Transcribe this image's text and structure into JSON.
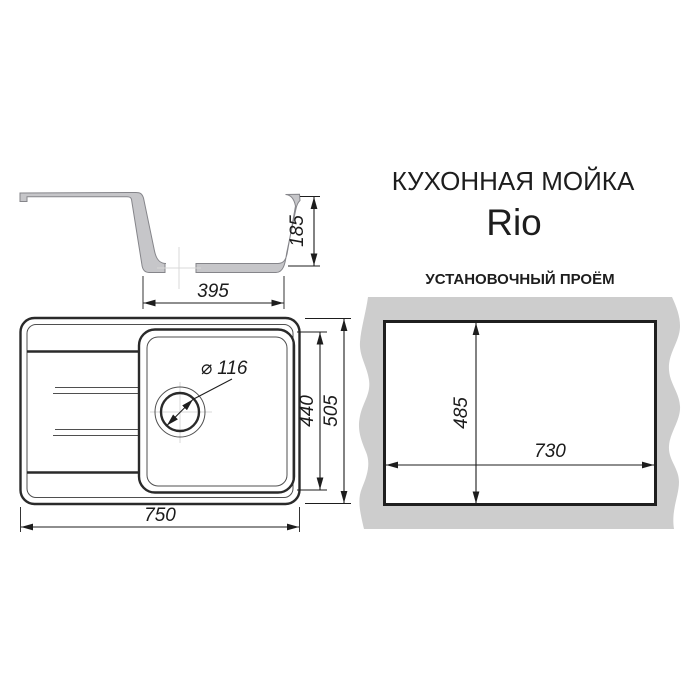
{
  "page": {
    "title_line1": "КУХОННАЯ МОЙКА",
    "title_line2": "Rio",
    "installation_title": "УСТАНОВОЧНЫЙ ПРОЁМ"
  },
  "dimensions": {
    "bowl_depth": "185",
    "bowl_width": "395",
    "bowl_length": "440",
    "sink_width": "505",
    "sink_length": "750",
    "drain_diameter": "⌀ 116",
    "cutout_height": "485",
    "cutout_length": "730"
  },
  "colors": {
    "background": "#ffffff",
    "profile_fill": "#c6c6c9",
    "profile_outline": "#85858a",
    "countertop_fill": "#cdcdcd",
    "drawing_line": "#2a2a2a",
    "dimension_line": "#1d1d1d",
    "centerline": "#d8d8d8"
  }
}
